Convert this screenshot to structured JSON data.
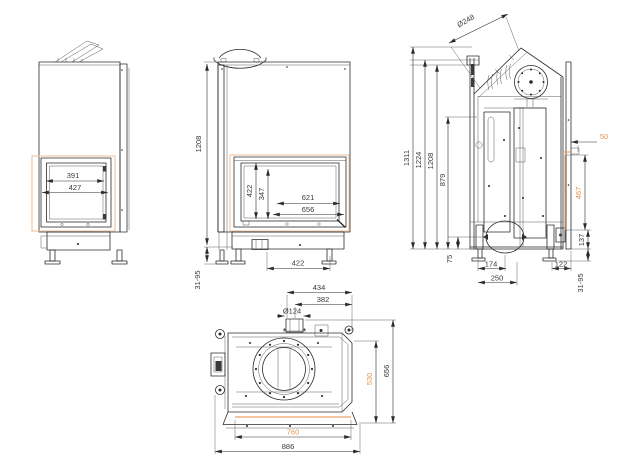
{
  "drawing_type": "fireplace-insert-dimension-drawing",
  "colors": {
    "line": "#2b2b2b",
    "text": "#3a3a3a",
    "accent_text": "#e2934f",
    "highlight_outline": "#efc3a0",
    "highlight_edge": "#eaa36b",
    "background": "#ffffff"
  },
  "views": {
    "front_left": {
      "dims": {
        "w391": "391",
        "w427": "427"
      }
    },
    "front_main": {
      "dims": {
        "h1208": "1208",
        "leg_range": "31-95",
        "h422": "422",
        "h347": "347",
        "w621": "621",
        "w656": "656",
        "w422": "422"
      }
    },
    "side": {
      "dims": {
        "flue": "Ø248",
        "h1311": "1311",
        "h1224": "1224",
        "h1208": "1208",
        "h879": "879",
        "h75": "75",
        "w174": "174",
        "w250": "250",
        "w122": "122",
        "h137": "137",
        "leg_range": "31-95",
        "off50": "50",
        "h467": "467"
      }
    },
    "top": {
      "dims": {
        "w434": "434",
        "w382": "382",
        "collar": "Ø124",
        "d656": "656",
        "d530": "530",
        "w760": "760",
        "w886": "886"
      }
    }
  }
}
